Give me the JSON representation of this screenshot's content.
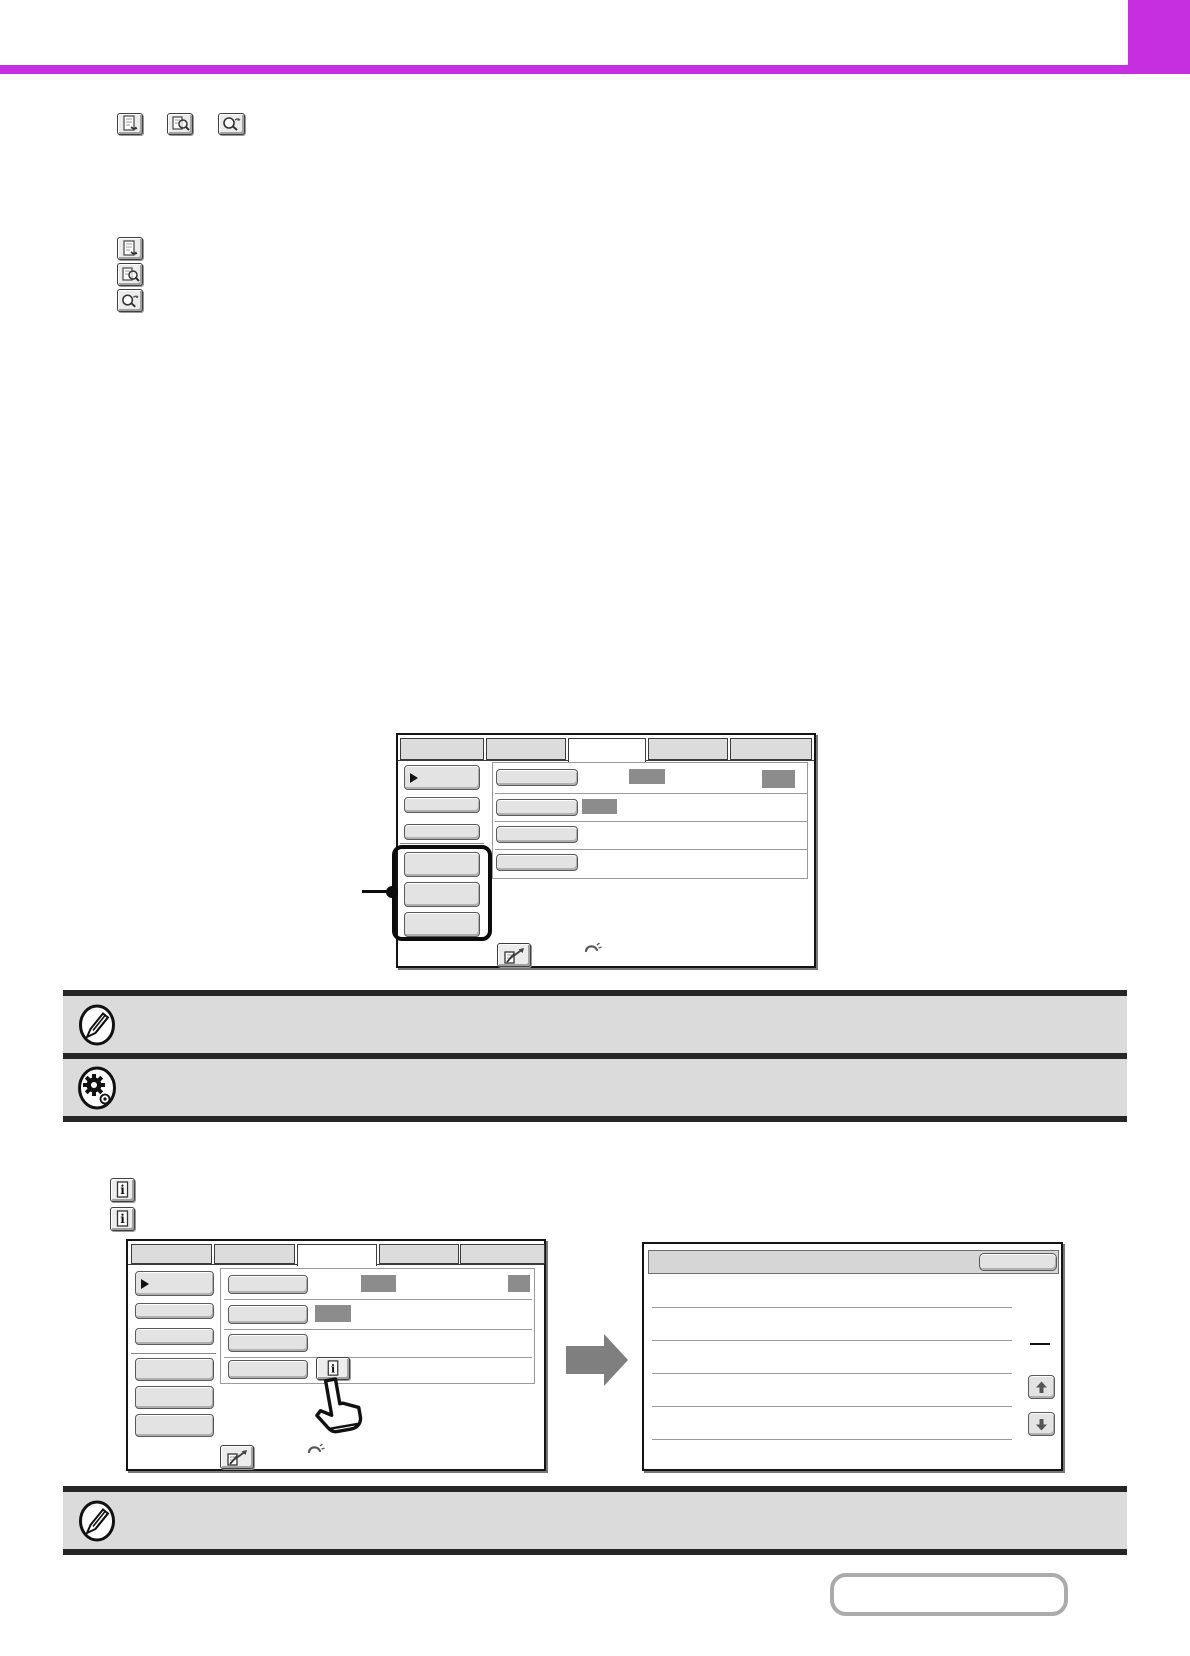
{
  "page": {
    "kind": "printed-manual-page",
    "visible_text_present": false
  },
  "colors": {
    "accent": "#C52FE0",
    "note_bar_bg": "#DBDBDB",
    "note_bar_border": "#262626",
    "key_bg": "#ECECEC",
    "key_border": "#3F3F3F",
    "screen_border": "#141414",
    "button_bg": "#E3E3E3",
    "button_border": "#5A5A5A",
    "placeholder": "#8C8C8C",
    "separator": "#9A9A9A",
    "arrow_gray": "#7F7F7F",
    "page_box_border": "#ABABAB"
  },
  "header": {
    "accent_bar": "full-width horizontal rule",
    "accent_corner_block": "solid block, top right corner"
  },
  "inline_keys": {
    "row_icons": [
      "file-key-icon",
      "document-magnifier-key-icon",
      "magnifier-key-icon"
    ],
    "column_icons": [
      "file-key-icon",
      "document-magnifier-key-icon",
      "magnifier-key-icon"
    ]
  },
  "figure1": {
    "tabs": {
      "count": 5,
      "selected_index": 2
    },
    "left_menu": {
      "button_count": 6,
      "first_button_has_arrow": true,
      "highlighted_buttons": [
        3,
        4,
        5
      ],
      "callout": "line with dot pointing to highlight box"
    },
    "rows": [
      {
        "has_button": true,
        "placeholder_blocks": 2
      },
      {
        "has_button": true,
        "placeholder_blocks": 1
      },
      {
        "has_button": true,
        "placeholder_blocks": 0
      },
      {
        "has_button": true,
        "placeholder_blocks": 0
      }
    ],
    "bottom_icons": [
      "document-send-key-icon",
      "phone-icon"
    ]
  },
  "notes": [
    {
      "icon": "pencil-note-icon"
    },
    {
      "icon": "gear-settings-icon"
    },
    {
      "icon": "pencil-note-icon"
    }
  ],
  "info_keys": [
    "information-key-icon",
    "information-key-icon"
  ],
  "figure2": {
    "left_screen": {
      "tabs": {
        "count": 5,
        "selected_index": 2
      },
      "left_menu": {
        "button_count": 6,
        "first_button_has_arrow": true
      },
      "rows": [
        {
          "has_button": true,
          "placeholder_blocks": 2
        },
        {
          "has_button": true,
          "placeholder_blocks": 1
        },
        {
          "has_button": true,
          "placeholder_blocks": 0
        },
        {
          "has_button": true,
          "placeholder_blocks": 0,
          "info_key": true
        }
      ],
      "hand_cursor": true,
      "bottom_icons": [
        "document-send-key-icon",
        "phone-icon"
      ]
    },
    "transition": "right-arrow",
    "right_screen": {
      "header_button": true,
      "list_row_separators": 5,
      "page_indicator_dash": true,
      "scroll_buttons": [
        "up",
        "down"
      ]
    }
  },
  "page_number_box": {
    "text": ""
  }
}
